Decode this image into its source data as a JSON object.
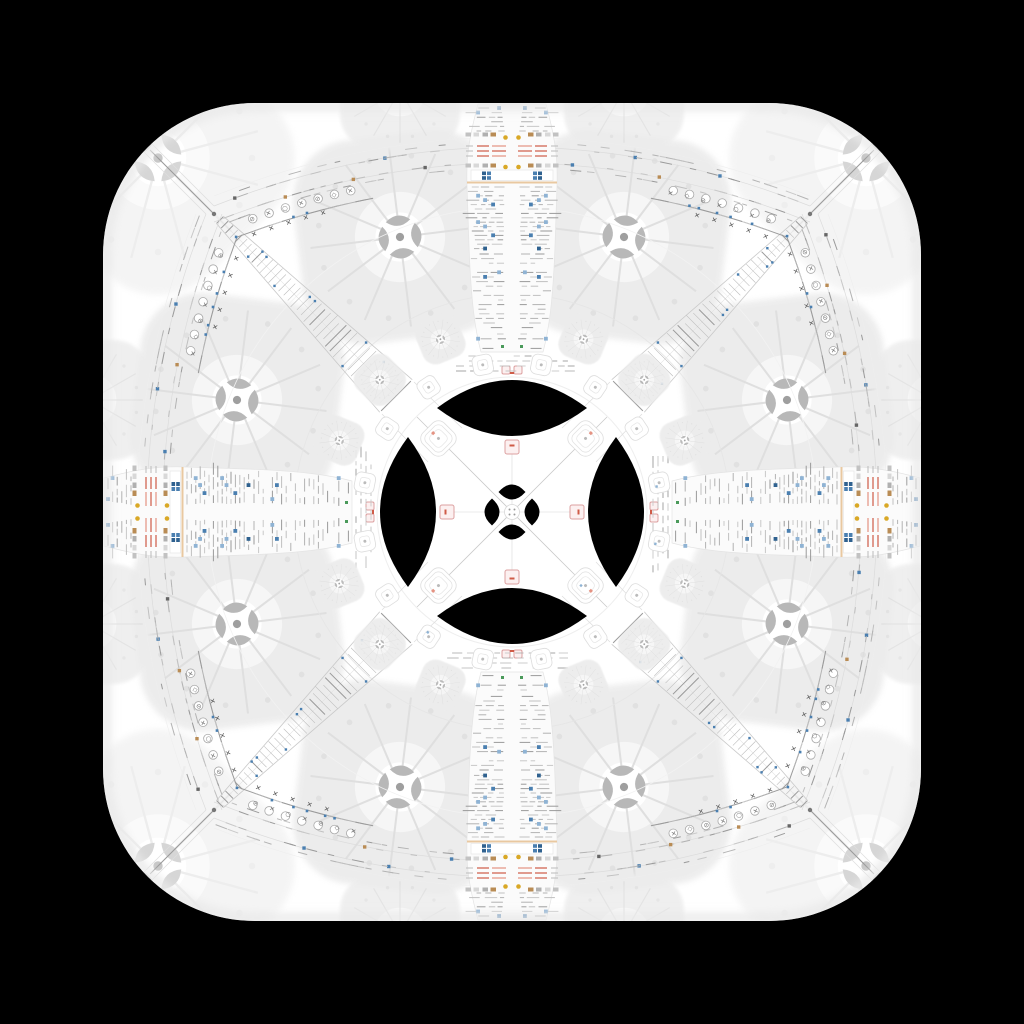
{
  "scene": {
    "width": 1024,
    "height": 1024,
    "background": "#000000",
    "description": "kaleidoscopic mirrored screenshot medallion inside rounded-square app tile"
  },
  "squircle": {
    "x": 103,
    "y": 103,
    "size": 818,
    "corner_radius": 152,
    "fill": "#ffffff"
  },
  "palette": {
    "black": "#000000",
    "white": "#ffffff",
    "paper": "#fbfbfb",
    "edge": "#e4e4e4",
    "dash_colors": [
      "#b3b3b3",
      "#c8c8c8",
      "#9a9a9a",
      "#c0c0c0"
    ],
    "blue": "#4a7fb0",
    "blue_dark": "#2f618f",
    "blue_light": "#8fb3d4",
    "tan": "#b98c55",
    "gold": "#d9a826",
    "red": "#cf5b47",
    "red_light": "#e49383",
    "pink_border": "#dca0a0",
    "pink_fill": "#fcf0f0",
    "rule_tan": "#e9c8a0",
    "hairline": "#dcdcdc",
    "tick": "#bdbdbd",
    "faint": "#ececec",
    "flower_fill": "#ececec",
    "glyph": "#777777",
    "green": "#4a9a5a",
    "junction": "#9a9a9a"
  },
  "symbols": {
    "slash_circle": "⊘",
    "cross": "✕",
    "circle": "○",
    "diamond": "◇"
  },
  "glyph_sequence": [
    "slash_circle",
    "cross",
    "circle",
    "cross",
    "slash_circle",
    "diamond",
    "cross"
  ],
  "medallion": {
    "big_lens": {
      "orbit": 104,
      "rx": 75,
      "half_height": 28
    },
    "mini_lens": {
      "orbit": 20,
      "rx": 13.5,
      "half_height": 7.5
    },
    "pink_marker": {
      "orbit": 65,
      "size": 14
    },
    "rings": [
      135,
      218,
      305
    ],
    "ring_band_rows": [
      356,
      361,
      366,
      371
    ],
    "tile_rings": [
      {
        "radius": 104,
        "size": 30,
        "style": "nest",
        "angles": [
          45,
          135,
          225,
          315
        ]
      },
      {
        "radius": 150,
        "size": 20,
        "style": "tile",
        "angles": [
          11.25,
          33.75,
          56.25,
          78.75,
          101.25,
          123.75,
          146.25,
          168.75,
          191.25,
          213.75,
          236.25,
          258.75,
          281.25,
          303.75,
          326.25,
          348.75
        ]
      },
      {
        "radius": 187,
        "size": 45,
        "style": "flower",
        "angles": [
          22.5,
          45,
          67.5,
          112.5,
          135,
          157.5,
          202.5,
          225,
          247.5,
          292.5,
          315,
          337.5
        ]
      }
    ]
  },
  "spoke": {
    "top_y": 104,
    "bottom_y": 352,
    "icon_rows": [
      134.5,
      165.5
    ],
    "icon_offsets": [
      16,
      24,
      33,
      41
    ],
    "icon_colors": [
      "#b98c55",
      "#b0b0b0",
      "#d8d8d8",
      "#c2c2c2"
    ],
    "gold_rows": [
      137.5,
      167
    ],
    "gold_offset": 6.5,
    "red_rows": [
      146,
      151,
      156
    ],
    "card": {
      "y0": 170,
      "y1": 180.5,
      "blue_offsets": [
        21,
        26
      ]
    },
    "rule_y": 181.5,
    "green_specks_y": 345,
    "tip_y": 366
  },
  "seam": {
    "p0": [
      214,
      214
    ],
    "ctrl": [
      512,
      96
    ],
    "p2": [
      810,
      214
    ],
    "row_offsets": [
      -13,
      -7.5,
      7.5,
      13
    ],
    "gap_half_width": 55,
    "icon_colors": [
      "#4a7fb0",
      "#b98c55",
      "#666666"
    ]
  },
  "corner": {
    "junction": [
      214,
      214
    ],
    "corner_point": [
      150,
      150
    ],
    "fan": {
      "center": [
        147,
        147
      ],
      "angle_start": 187,
      "angle_end": 263,
      "step": 4.2,
      "inner_radius": 18,
      "arc_radii": [
        40,
        72
      ]
    },
    "ladder": {
      "from": 220,
      "to": 396,
      "width_start": 10,
      "width_end": 46,
      "ticks": 38
    }
  },
  "flowers": {
    "large": [
      [
        400,
        237,
        205,
        -7,
        0.95
      ],
      [
        624,
        237,
        205,
        7,
        0.95
      ],
      [
        237,
        400,
        205,
        7,
        0.95
      ],
      [
        237,
        624,
        205,
        -7,
        0.95
      ],
      [
        787,
        400,
        205,
        -7,
        0.95
      ],
      [
        787,
        624,
        205,
        7,
        0.95
      ],
      [
        400,
        787,
        205,
        7,
        0.95
      ],
      [
        624,
        787,
        205,
        -7,
        0.95
      ]
    ],
    "corner": [
      [
        158,
        158,
        235,
        45,
        0.55
      ],
      [
        866,
        158,
        235,
        45,
        0.55
      ],
      [
        158,
        866,
        235,
        45,
        0.55
      ],
      [
        866,
        866,
        235,
        45,
        0.55
      ]
    ],
    "edge": [
      [
        400,
        90,
        120,
        0,
        0.8
      ],
      [
        624,
        90,
        120,
        0,
        0.8
      ],
      [
        90,
        400,
        120,
        0,
        0.8
      ],
      [
        90,
        624,
        120,
        0,
        0.8
      ],
      [
        934,
        400,
        120,
        0,
        0.8
      ],
      [
        934,
        624,
        120,
        0,
        0.8
      ],
      [
        400,
        934,
        120,
        0,
        0.8
      ],
      [
        624,
        934,
        120,
        0,
        0.8
      ]
    ]
  }
}
